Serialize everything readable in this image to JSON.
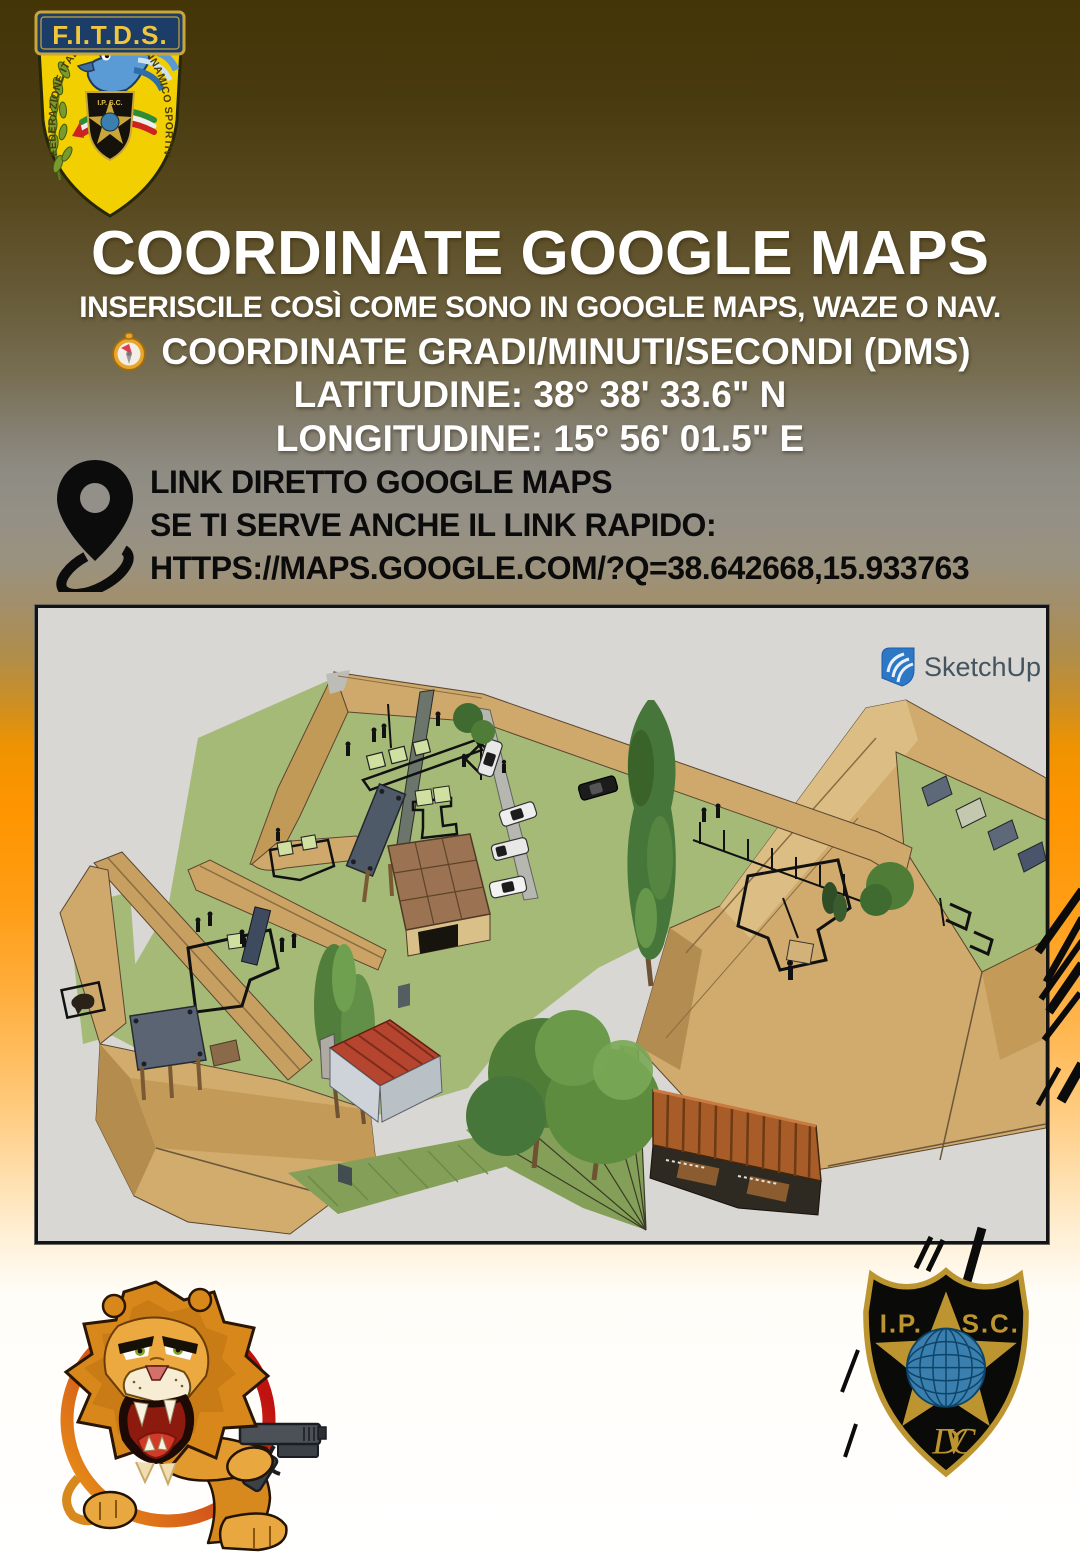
{
  "colors": {
    "accent_orange": "#ff9800",
    "top_brown": "#443507",
    "gold": "#bd9530",
    "ipsc_globe_blue": "#3a7fae",
    "fitds_yellow": "#f2cf00",
    "text_white": "#ffffff",
    "text_black": "#0b0b0b"
  },
  "icons": {
    "compass": "compass-emoji-icon",
    "map_pin": "map-pin-icon",
    "speed_lines": "comic-speed-lines",
    "fitds_shield": "fitds-eagle-shield",
    "ipsc_shield": "ipsc-star-globe-shield",
    "lion": "lion-with-pistol-logo",
    "sketchup": "sketchup-logo-icon"
  },
  "header": {
    "title": "COORDINATE GOOGLE MAPS",
    "subtitle": "INSERISCILE COSÌ COME SONO IN GOOGLE MAPS, WAZE O NAV.",
    "dms_heading": "COORDINATE GRADI/MINUTI/SECONDI (DMS)",
    "latitude": "LATITUDINE: 38° 38' 33.6\" N",
    "longitude": "LONGITUDINE: 15° 56' 01.5\" E"
  },
  "link_block": {
    "line1": "LINK DIRETTO GOOGLE MAPS",
    "line2": "SE TI SERVE ANCHE IL LINK RAPIDO:",
    "line3": "HTTPS://MAPS.GOOGLE.COM/?Q=38.642668,15.933763"
  },
  "logos": {
    "fitds": {
      "banner": "F.I.T.D.S.",
      "arc_left": "FEDERAZIONE ITALIANA",
      "arc_right": "TIRO DINAMICO SPORTIVO",
      "mini": "I.P. S.C."
    },
    "sketchup": {
      "label": "SketchUp"
    },
    "ipsc": {
      "left": "I.P.",
      "right": "S.C.",
      "monogram": "DVC"
    }
  }
}
